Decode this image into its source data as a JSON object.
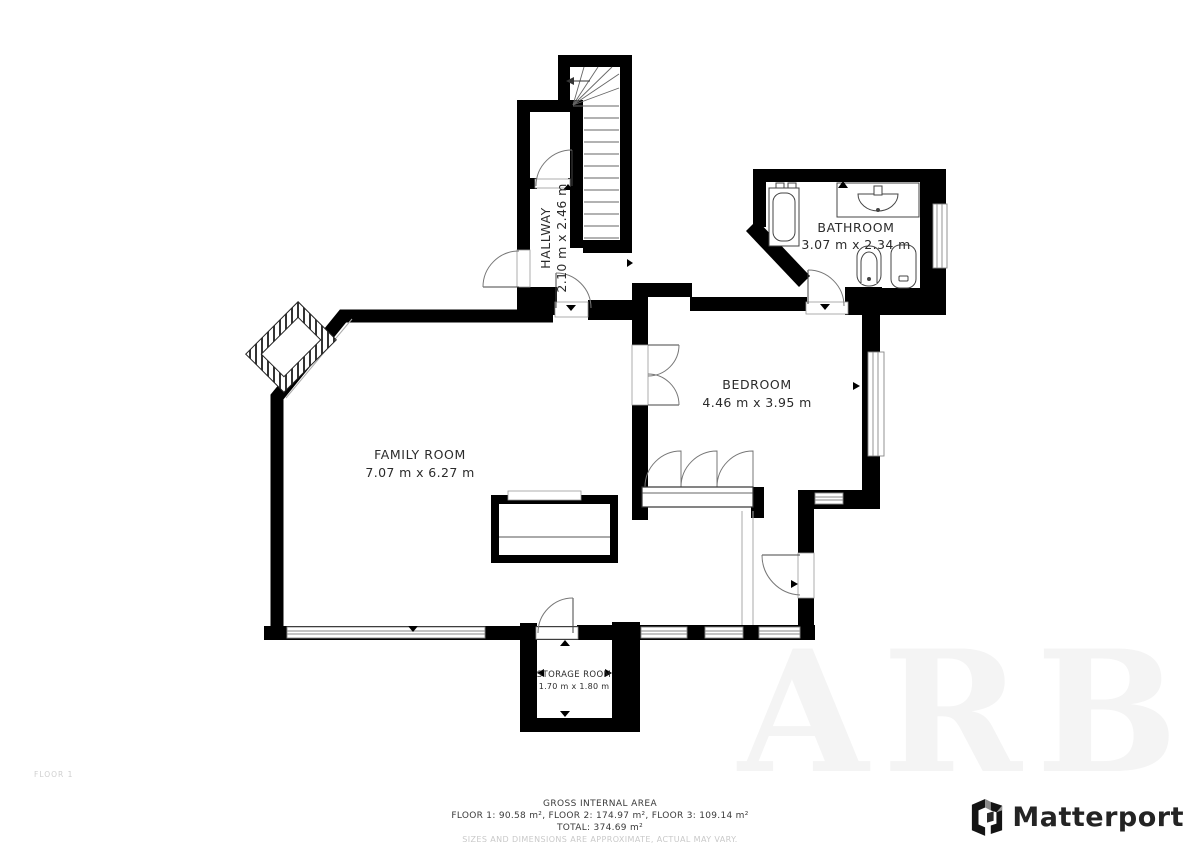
{
  "floor_plan": {
    "floor_label": "FLOOR 1",
    "rooms": {
      "hallway": {
        "name": "HALLWAY",
        "dims": "2.10 m x 2.46 m"
      },
      "bathroom": {
        "name": "BATHROOM",
        "dims": "3.07 m x 2.34 m"
      },
      "bedroom": {
        "name": "BEDROOM",
        "dims": "4.46 m x 3.95 m"
      },
      "family_room": {
        "name": "FAMILY ROOM",
        "dims": "7.07 m x 6.27 m"
      },
      "storage_room": {
        "name": "STORAGE ROOM",
        "dims": "1.70 m x 1.80 m"
      }
    }
  },
  "footer": {
    "title": "GROSS INTERNAL AREA",
    "floors": "FLOOR 1: 90.58 m², FLOOR 2: 174.97 m², FLOOR 3: 109.14 m²",
    "total": "TOTAL: 374.69 m²",
    "disclaimer": "SIZES AND DIMENSIONS ARE APPROXIMATE, ACTUAL MAY VARY."
  },
  "branding": {
    "name": "Matterport"
  },
  "watermark": {
    "text": "ARB"
  },
  "colors": {
    "wall": "#000000",
    "fixture_line": "#555555",
    "muted": "#c9c9c9",
    "logo": "#242424"
  }
}
